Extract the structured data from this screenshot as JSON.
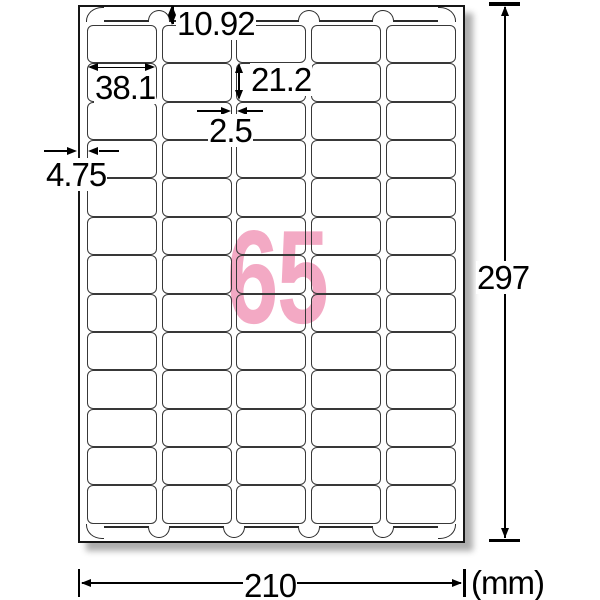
{
  "sheet": {
    "label_count": "65",
    "rows": 13,
    "columns": 5
  },
  "dimensions": {
    "top_margin_mm": "10.92",
    "label_width_mm": "38.1",
    "label_height_mm": "21.2",
    "column_gap_mm": "2.5",
    "side_margin_mm": "4.75",
    "sheet_height_mm": "297",
    "sheet_width_mm": "210",
    "unit_label": "(mm)"
  },
  "colors": {
    "label_count_accent": "#f3a9c4",
    "line_color": "#2b2b2b"
  }
}
